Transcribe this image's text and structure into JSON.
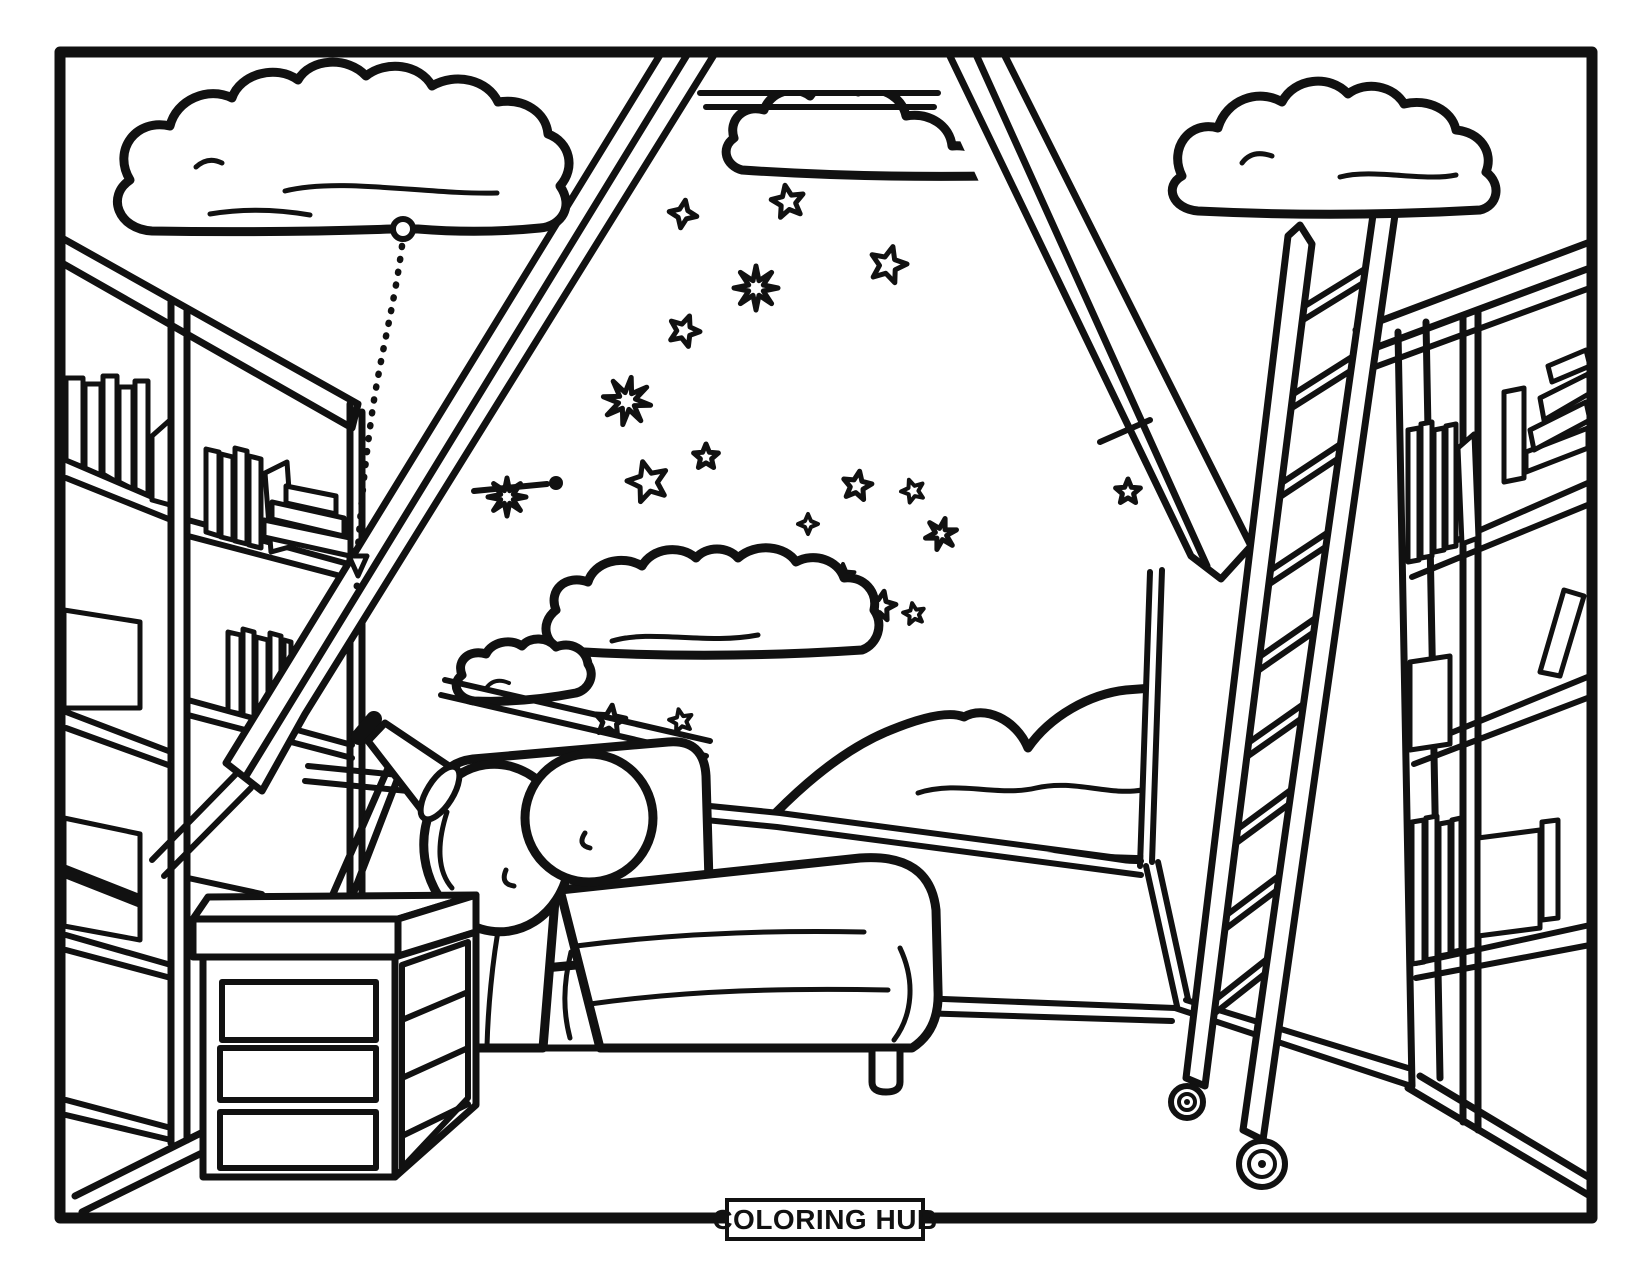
{
  "page": {
    "paper_color": "#ffffff",
    "ink_color": "#111111"
  },
  "badge": {
    "label": "COLORING HUB"
  },
  "scene": {
    "stars": [
      {
        "x": 683,
        "y": 214,
        "points": 4,
        "r": 14,
        "rot": 10,
        "layer": "window"
      },
      {
        "x": 788,
        "y": 202,
        "points": 5,
        "r": 17,
        "rot": -10,
        "layer": "window"
      },
      {
        "x": 888,
        "y": 265,
        "points": 5,
        "r": 19,
        "rot": 15,
        "layer": "window"
      },
      {
        "x": 756,
        "y": 288,
        "points": 8,
        "r": 22,
        "rot": 0,
        "layer": "window"
      },
      {
        "x": 684,
        "y": 331,
        "points": 5,
        "r": 16,
        "rot": 20,
        "layer": "window"
      },
      {
        "x": 627,
        "y": 401,
        "points": 8,
        "r": 24,
        "rot": 10,
        "layer": "window"
      },
      {
        "x": 648,
        "y": 482,
        "points": 5,
        "r": 21,
        "rot": -15,
        "layer": "window"
      },
      {
        "x": 706,
        "y": 457,
        "points": 5,
        "r": 13,
        "rot": 0,
        "layer": "window"
      },
      {
        "x": 857,
        "y": 486,
        "points": 5,
        "r": 15,
        "rot": 10,
        "layer": "window"
      },
      {
        "x": 913,
        "y": 491,
        "points": 5,
        "r": 12,
        "rot": -20,
        "layer": "window"
      },
      {
        "x": 808,
        "y": 524,
        "points": 4,
        "r": 10,
        "rot": 0,
        "layer": "window"
      },
      {
        "x": 941,
        "y": 534,
        "points": 6,
        "r": 16,
        "rot": 15,
        "layer": "window"
      },
      {
        "x": 843,
        "y": 576,
        "points": 5,
        "r": 12,
        "rot": 0,
        "layer": "window"
      },
      {
        "x": 881,
        "y": 606,
        "points": 5,
        "r": 15,
        "rot": 12,
        "layer": "window"
      },
      {
        "x": 914,
        "y": 614,
        "points": 5,
        "r": 11,
        "rot": -10,
        "layer": "window"
      },
      {
        "x": 610,
        "y": 721,
        "points": 5,
        "r": 16,
        "rot": 8,
        "layer": "window"
      },
      {
        "x": 681,
        "y": 721,
        "points": 5,
        "r": 12,
        "rot": -12,
        "layer": "window"
      },
      {
        "x": 575,
        "y": 772,
        "points": 6,
        "r": 20,
        "rot": 0,
        "layer": "window"
      },
      {
        "x": 641,
        "y": 790,
        "points": 5,
        "r": 14,
        "rot": 15,
        "layer": "window"
      },
      {
        "x": 507,
        "y": 497,
        "points": 8,
        "r": 19,
        "rot": 0,
        "layer": "window"
      },
      {
        "x": 1128,
        "y": 492,
        "points": 5,
        "r": 13,
        "rot": 0,
        "layer": "wall"
      }
    ]
  }
}
